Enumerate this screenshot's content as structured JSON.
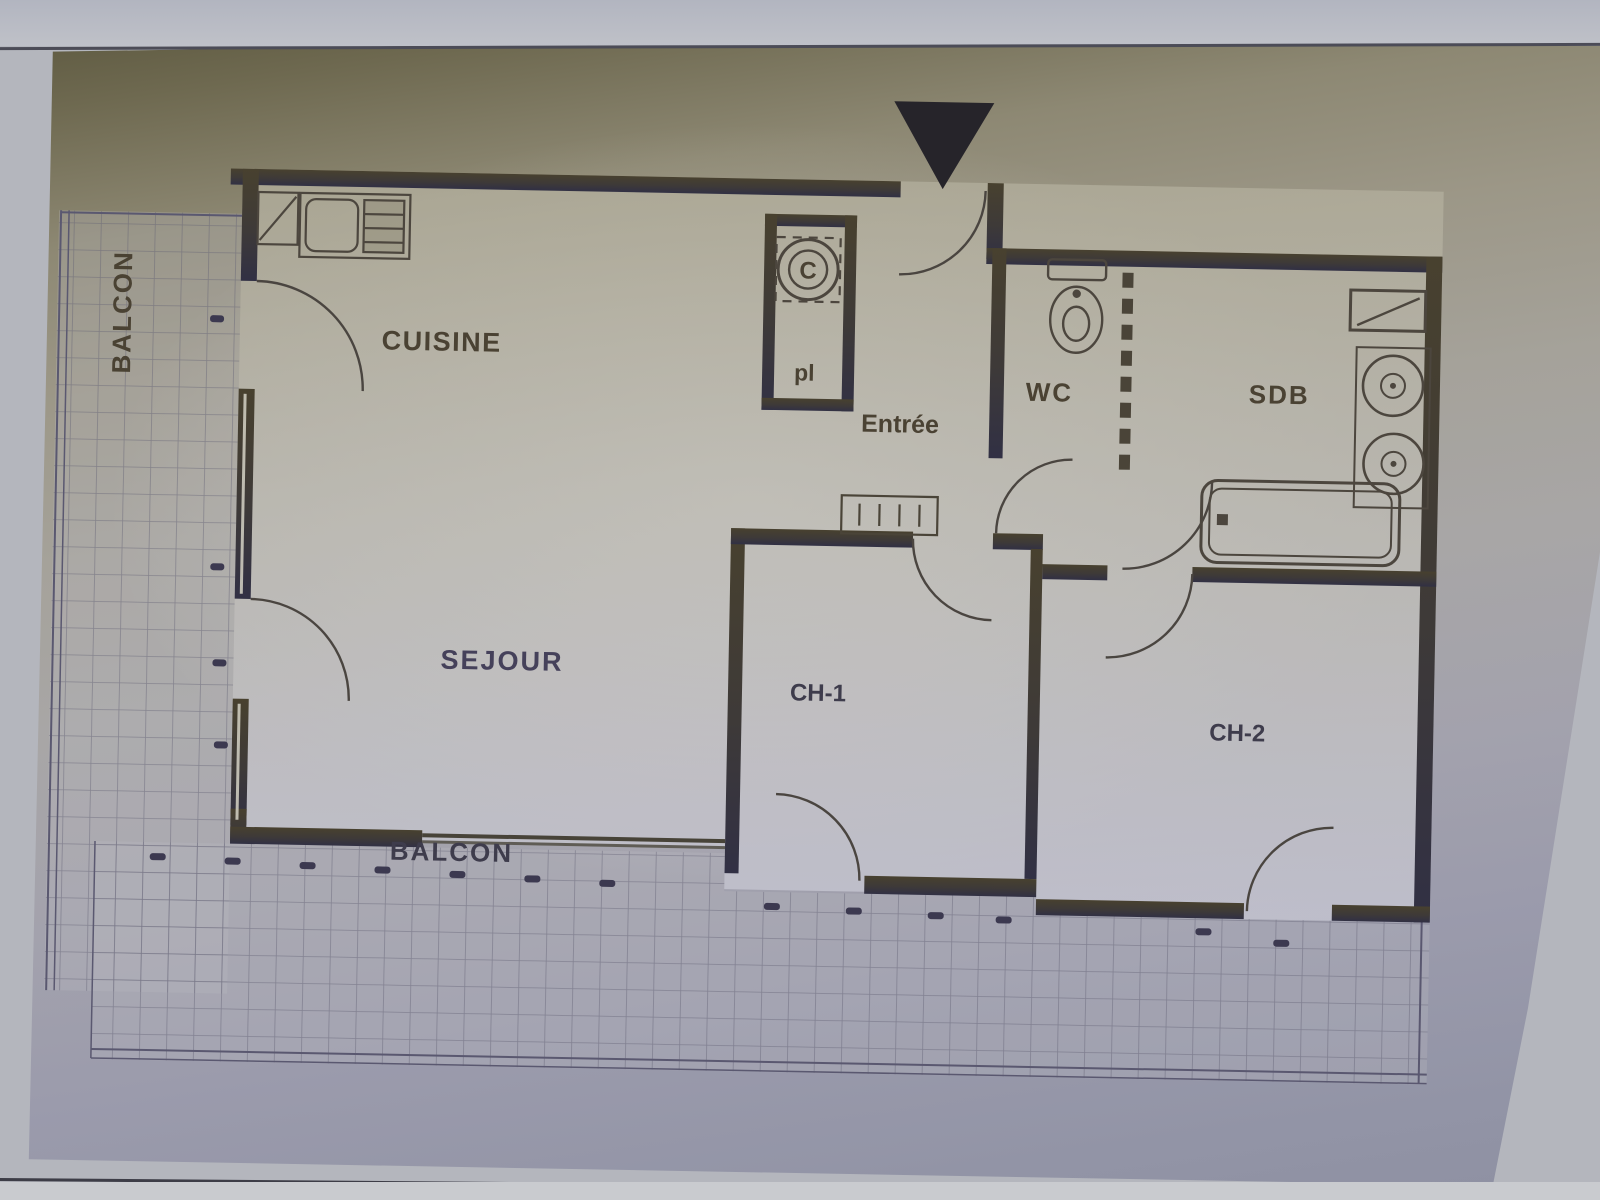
{
  "photo": {
    "kind": "photographed floor plan",
    "orientation_marker": "entrance triangle"
  },
  "plan": {
    "labels": {
      "cuisine": "CUISINE",
      "sejour": "SEJOUR",
      "entree": "Entrée",
      "placard": "pl",
      "wc": "WC",
      "sdb": "SDB",
      "ch1": "CH-1",
      "ch2": "CH-2",
      "balcon_left": "BALCON",
      "balcon_bottom": "BALCON",
      "water_heater": "C"
    },
    "colors": {
      "wall_top": "#48412f",
      "wall_bottom": "#313044",
      "label_olive": "#4a4233",
      "label_slate": "#3e3c4c",
      "grid_line": "#5f5d72",
      "photo_top": "#57533a",
      "photo_bottom": "#8e90a2",
      "screen_band": "#bfc1c8"
    }
  }
}
